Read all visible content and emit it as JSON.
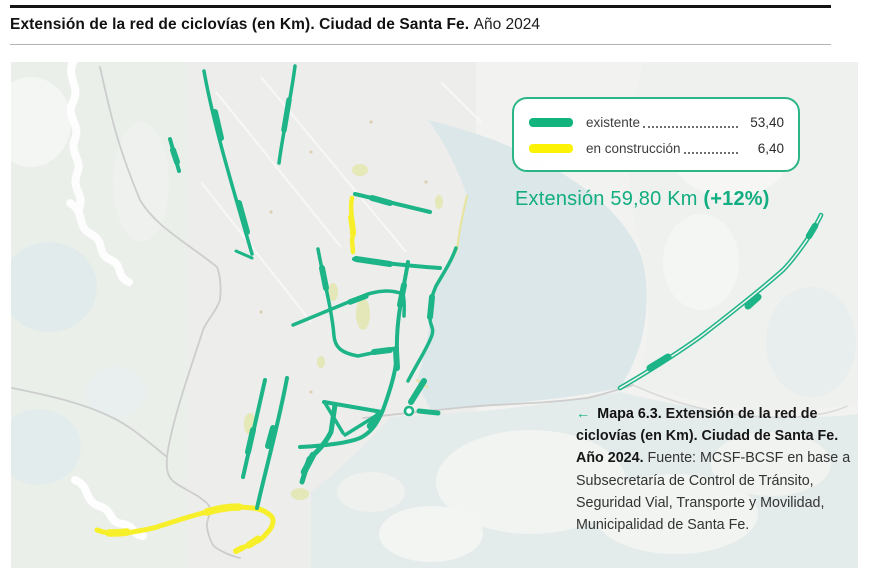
{
  "header": {
    "title_bold": "Extensión de la red de ciclovías (en Km). Ciudad de Santa Fe.",
    "title_regular": "Año 2024"
  },
  "legend": {
    "items": [
      {
        "label": "existente",
        "value": "53,40",
        "color": "#12b47e",
        "status": "existing"
      },
      {
        "label": "en construcción",
        "value": "6,40",
        "color": "#fbf303",
        "status": "under-construction"
      }
    ]
  },
  "summary": {
    "text": "Extensión 59,80 Km",
    "highlight": "(+12%)",
    "color": "#12ad80"
  },
  "caption": {
    "arrow": "←",
    "map_label": "Mapa 6.3.",
    "title": "Extensión de la red de ciclovías (en Km). Ciudad de Santa Fe. Año 2024.",
    "source": "Fuente: MCSF-BCSF en base a Subsecretaría de Control de Tránsito, Seguridad Vial, Transporte y Movilidad, Municipalidad de Santa Fe."
  },
  "map": {
    "existing_color": "#1db488",
    "construction_color": "#f6ee33",
    "existing_km": 53.4,
    "construction_km": 6.4,
    "total_km": 59.8,
    "growth_percent": 12
  }
}
